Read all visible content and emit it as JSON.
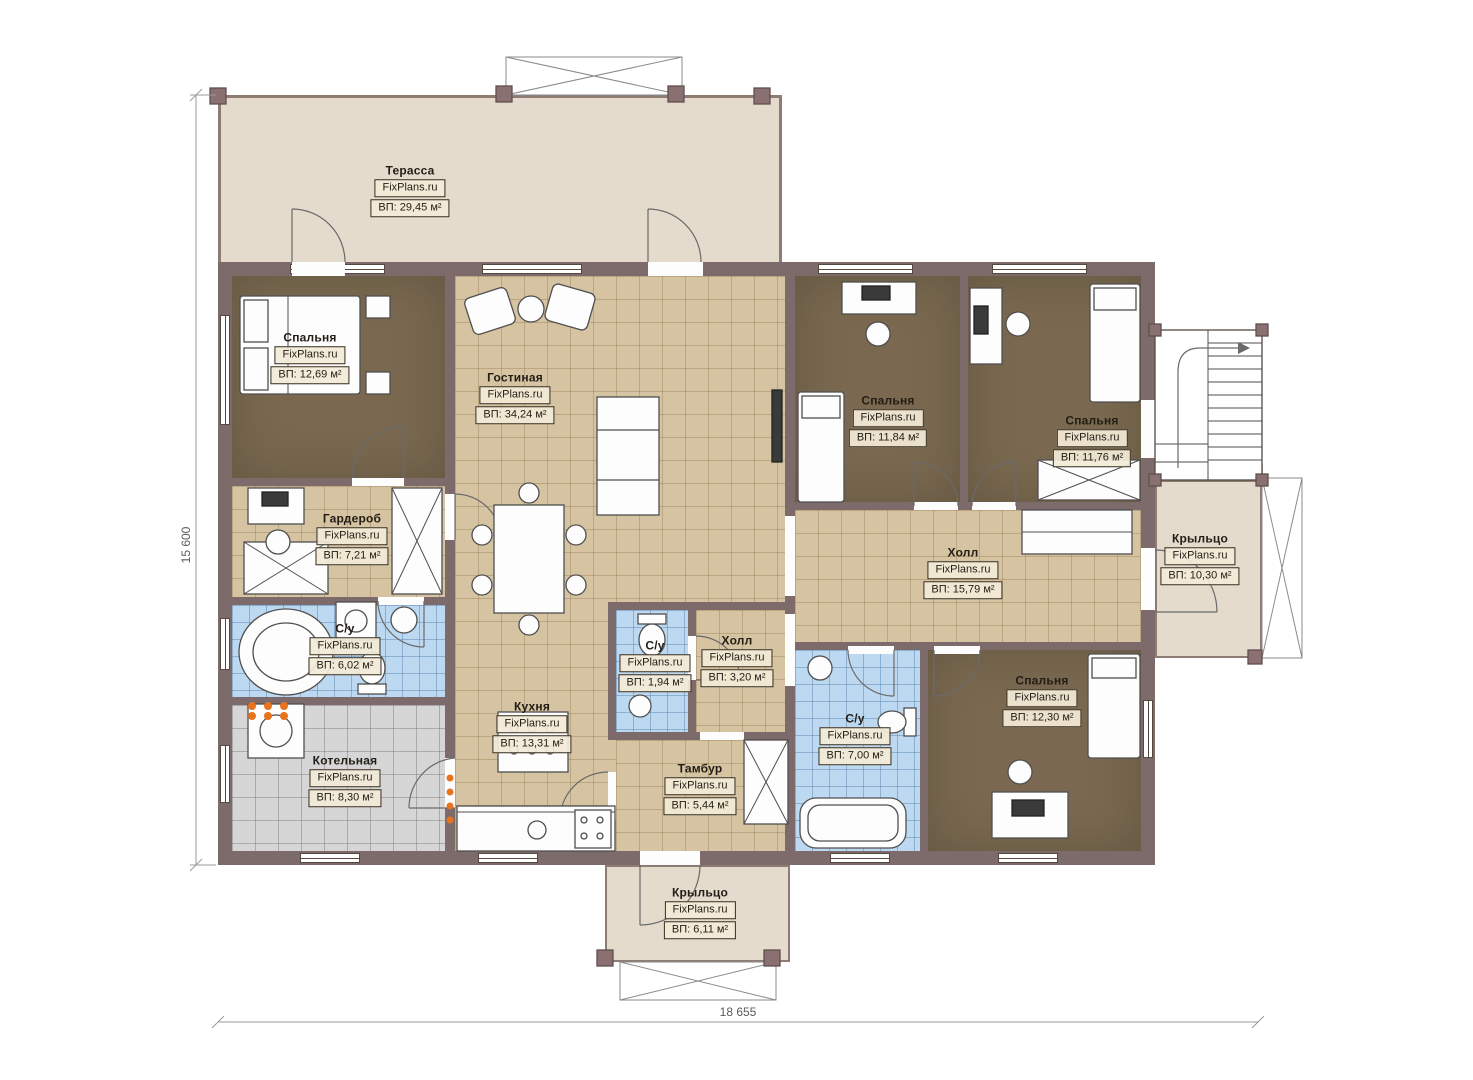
{
  "watermark": "FixPlans.ru",
  "rooms": [
    {
      "name": "Терасса",
      "area": "ВП: 29,45 м²"
    },
    {
      "name": "Спальня",
      "area": "ВП: 12,69 м²"
    },
    {
      "name": "Гостиная",
      "area": "ВП: 34,24 м²"
    },
    {
      "name": "Спальня",
      "area": "ВП: 11,84 м²"
    },
    {
      "name": "Спальня",
      "area": "ВП: 11,76 м²"
    },
    {
      "name": "Гардероб",
      "area": "ВП: 7,21 м²"
    },
    {
      "name": "Холл",
      "area": "ВП: 15,79 м²"
    },
    {
      "name": "Крыльцо",
      "area": "ВП: 10,30 м²"
    },
    {
      "name": "С/у",
      "area": "ВП: 6,02 м²"
    },
    {
      "name": "С/у",
      "area": "ВП: 1,94 м²"
    },
    {
      "name": "Холл",
      "area": "ВП: 3,20 м²"
    },
    {
      "name": "Спальня",
      "area": "ВП: 12,30 м²"
    },
    {
      "name": "С/у",
      "area": "ВП: 7,00 м²"
    },
    {
      "name": "Кухня",
      "area": "ВП: 13,31 м²"
    },
    {
      "name": "Котельная",
      "area": "ВП: 8,30 м²"
    },
    {
      "name": "Тамбур",
      "area": "ВП: 5,44 м²"
    },
    {
      "name": "Крыльцо",
      "area": "ВП: 6,11 м²"
    }
  ],
  "dimensions": {
    "height": "15 600",
    "width": "18 655"
  },
  "colors": {
    "wall": "#7d6a6a",
    "tile_beige": "#d5c3a1",
    "tile_blue": "#bdd9f1",
    "tile_gray": "#d6d6d6",
    "floor_brown": "#7a6950",
    "terrace": "#e4dbcd",
    "accent_orange": "#e8731e"
  }
}
